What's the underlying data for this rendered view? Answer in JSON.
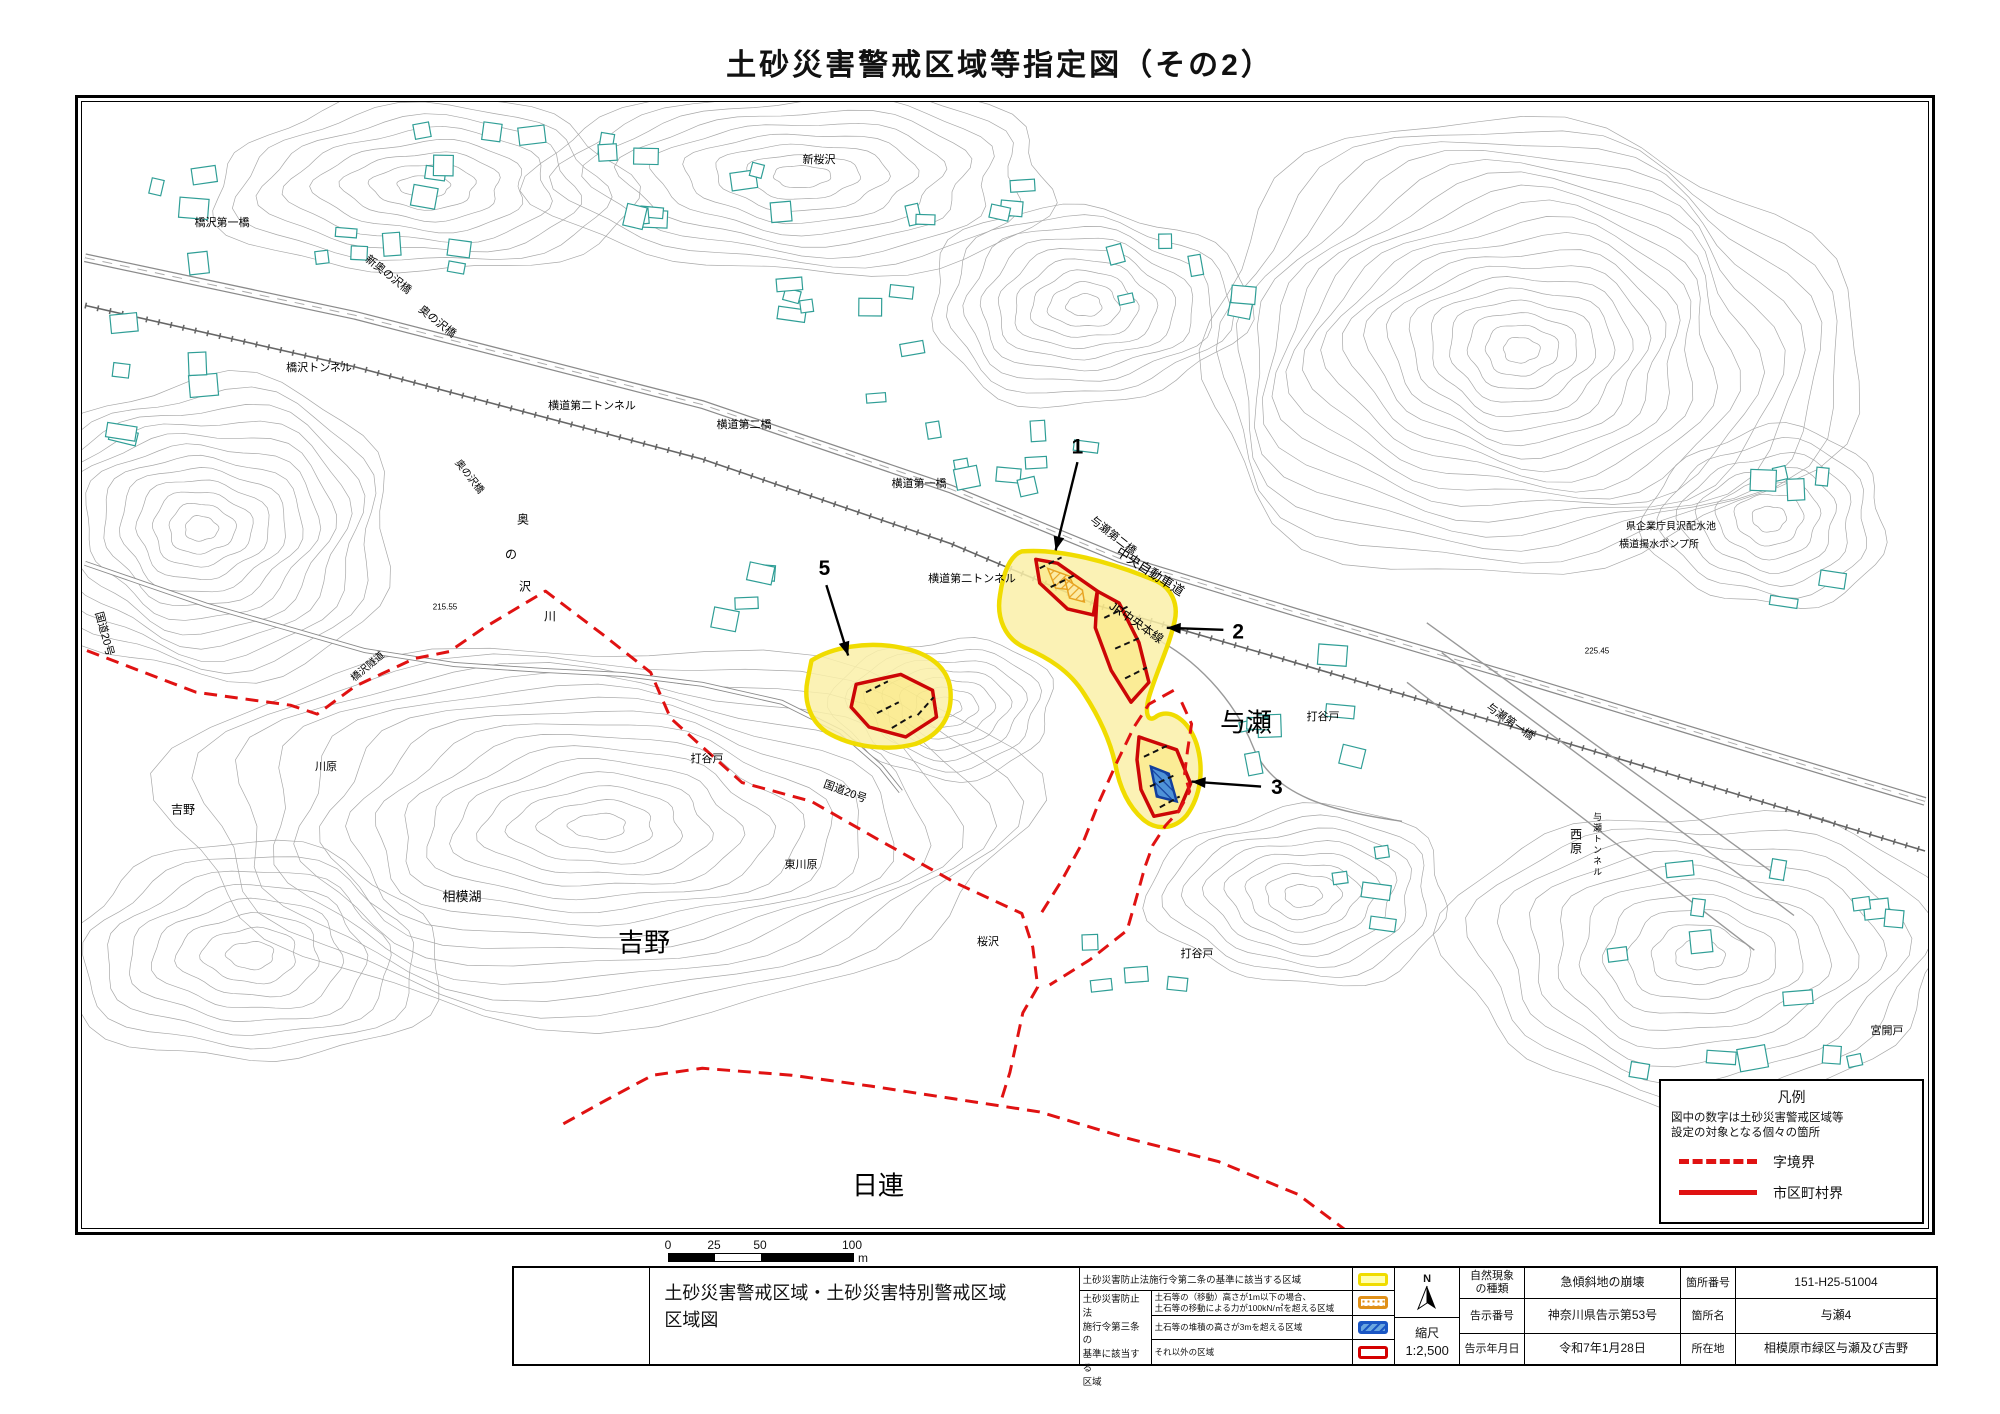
{
  "page_title": "土砂災害警戒区域等指定図（その2）",
  "map": {
    "labels": [
      {
        "text": "橋沢第一橋",
        "x": 140,
        "y": 121,
        "fs": 11
      },
      {
        "text": "新奥の沢橋",
        "x": 306,
        "y": 173,
        "fs": 11,
        "rot": 38
      },
      {
        "text": "奥の沢橋",
        "x": 355,
        "y": 220,
        "fs": 11,
        "rot": 38
      },
      {
        "text": "橋沢トンネル",
        "x": 237,
        "y": 266,
        "fs": 11
      },
      {
        "text": "横道第二トンネル",
        "x": 510,
        "y": 304,
        "fs": 11
      },
      {
        "text": "横道第二橋",
        "x": 662,
        "y": 323,
        "fs": 11
      },
      {
        "text": "横道第一橋",
        "x": 837,
        "y": 382,
        "fs": 11
      },
      {
        "text": "与瀬第二橋",
        "x": 1031,
        "y": 434,
        "fs": 11,
        "rot": 38
      },
      {
        "text": "中央自動車道",
        "x": 1068,
        "y": 470,
        "fs": 13,
        "rot": 33
      },
      {
        "text": "JR中央本線",
        "x": 1054,
        "y": 521,
        "fs": 12,
        "rot": 35
      },
      {
        "text": "横道第二トンネル",
        "x": 890,
        "y": 477,
        "fs": 11
      },
      {
        "text": "新桜沢",
        "x": 737,
        "y": 58,
        "fs": 11
      },
      {
        "text": "与瀬",
        "x": 1164,
        "y": 621,
        "fs": 26
      },
      {
        "text": "打谷戸",
        "x": 1241,
        "y": 615,
        "fs": 11
      },
      {
        "text": "打谷戸",
        "x": 625,
        "y": 657,
        "fs": 11
      },
      {
        "text": "打谷戸",
        "x": 1115,
        "y": 852,
        "fs": 11
      },
      {
        "text": "桜沢",
        "x": 906,
        "y": 840,
        "fs": 11
      },
      {
        "text": "東川原",
        "x": 719,
        "y": 763,
        "fs": 11
      },
      {
        "text": "国道20号",
        "x": 763,
        "y": 690,
        "fs": 11,
        "rot": 20
      },
      {
        "text": "日連",
        "x": 796,
        "y": 1084,
        "fs": 26
      },
      {
        "text": "吉野",
        "x": 562,
        "y": 841,
        "fs": 26
      },
      {
        "text": "吉野",
        "x": 101,
        "y": 708,
        "fs": 12
      },
      {
        "text": "川原",
        "x": 244,
        "y": 665,
        "fs": 11
      },
      {
        "text": "相模湖",
        "x": 380,
        "y": 795,
        "fs": 13
      },
      {
        "text": "国道20号",
        "x": 22,
        "y": 532,
        "fs": 11,
        "rot": 75
      },
      {
        "text": "橋沢隧道",
        "x": 286,
        "y": 565,
        "fs": 10,
        "rot": -40
      },
      {
        "text": "215.55",
        "x": 363,
        "y": 506,
        "fs": 8
      },
      {
        "text": "奥",
        "x": 441,
        "y": 418,
        "fs": 12
      },
      {
        "text": "の",
        "x": 429,
        "y": 453,
        "fs": 12
      },
      {
        "text": "沢",
        "x": 443,
        "y": 485,
        "fs": 12
      },
      {
        "text": "川",
        "x": 468,
        "y": 515,
        "fs": 12
      },
      {
        "text": "奥の沢橋",
        "x": 387,
        "y": 375,
        "fs": 10,
        "rot": 52
      },
      {
        "text": "県企業庁貝沢配水池",
        "x": 1589,
        "y": 425,
        "fs": 10
      },
      {
        "text": "横道揚水ポンプ所",
        "x": 1577,
        "y": 443,
        "fs": 10
      },
      {
        "text": "225.45",
        "x": 1515,
        "y": 550,
        "fs": 8
      },
      {
        "text": "与瀬第一橋",
        "x": 1428,
        "y": 620,
        "fs": 11,
        "rot": 35
      },
      {
        "text": "西原",
        "x": 1493,
        "y": 740,
        "fs": 12,
        "vert": true
      },
      {
        "text": "与瀬トンネル",
        "x": 1514,
        "y": 743,
        "fs": 9,
        "vert": true
      },
      {
        "text": "宮開戸",
        "x": 1805,
        "y": 929,
        "fs": 11
      }
    ],
    "markers": [
      {
        "num": "1",
        "tx": 1003,
        "ty": 348,
        "x1": 1003,
        "y1": 363,
        "x2": 981,
        "y2": 452
      },
      {
        "num": "2",
        "tx": 1165,
        "ty": 534,
        "x1": 1150,
        "y1": 532,
        "x2": 1093,
        "y2": 530
      },
      {
        "num": "3",
        "tx": 1204,
        "ty": 691,
        "x1": 1188,
        "y1": 690,
        "x2": 1118,
        "y2": 685
      },
      {
        "num": "5",
        "tx": 748,
        "ty": 470,
        "x1": 750,
        "y1": 487,
        "x2": 772,
        "y2": 558
      }
    ],
    "legend_box": {
      "title": "凡例",
      "note": "図中の数字は土砂災害警戒区域等\n設定の対象となる個々の箇所",
      "items": [
        {
          "label": "字境界",
          "style": "dashed"
        },
        {
          "label": "市区町村界",
          "style": "solid"
        }
      ]
    }
  },
  "scale_bar": {
    "ticks": [
      "0",
      "25",
      "50",
      "100"
    ],
    "unit": "m"
  },
  "title_block": {
    "map_title": "土砂災害警戒区域・土砂災害特別警戒区域\n区域図",
    "legend": {
      "row1_desc": "土砂災害防止法施行令第二条の基準に該当する区域",
      "group_label": "土砂災害防止法\n施行令第三条の\n基準に該当する\n区域",
      "rows": [
        {
          "desc": "土石等の（移動）高さが1m以下の場合、\n土石等の移動による力が100kN/㎡を超える区域",
          "swatch": "orange"
        },
        {
          "desc": "土石等の堆積の高さが3mを超える区域",
          "swatch": "blue"
        },
        {
          "desc": "それ以外の区域",
          "swatch": "red"
        }
      ]
    },
    "compass": {
      "north": "N"
    },
    "scale": {
      "label": "縮尺",
      "value": "1:2,500"
    },
    "info": {
      "rows": [
        {
          "h1": "自然現象\nの種類",
          "v1": "急傾斜地の崩壊",
          "h2": "箇所番号",
          "v2": "151-H25-51004"
        },
        {
          "h1": "告示番号",
          "v1": "神奈川県告示第53号",
          "h2": "箇所名",
          "v2": "与瀬4"
        },
        {
          "h1": "告示年月日",
          "v1": "令和7年1月28日",
          "h2": "所在地",
          "v2": "相模原市緑区与瀬及び吉野"
        }
      ]
    }
  },
  "colors": {
    "zone_yellow_border": "#f0dc00",
    "zone_yellow_fill": "#faf0a8",
    "zone_red": "#cc0606",
    "zone_orange": "#e09018",
    "zone_blue": "#1a56c4",
    "boundary_red": "#e01212",
    "building_teal": "#2f9e96",
    "contour_gray": "#a8a8a8"
  }
}
